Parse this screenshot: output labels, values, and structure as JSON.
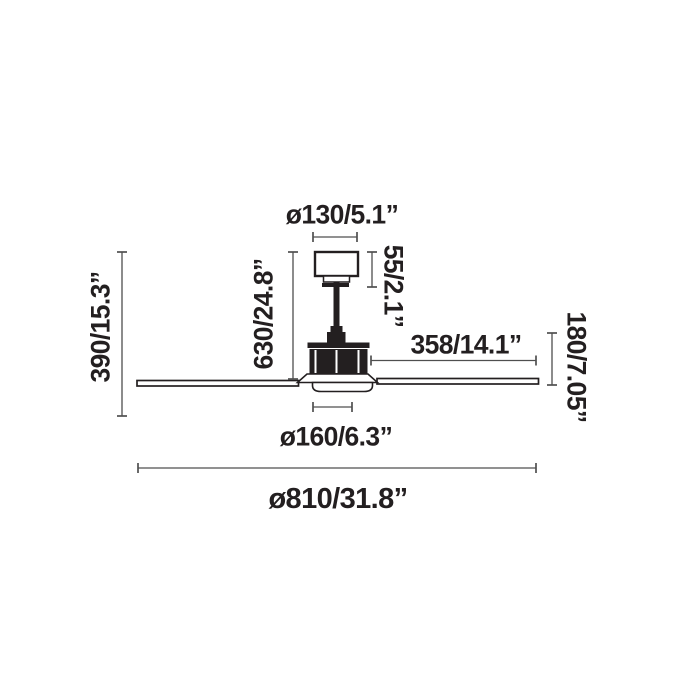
{
  "diagram": {
    "labels": {
      "canopy_diameter": "ø130/5.1”",
      "canopy_height": "55/2.1”",
      "height_to_blades": "630/24.8”",
      "total_height": "390/15.3”",
      "blade_length": "358/14.1”",
      "body_height": "180/7.05”",
      "body_diameter": "ø160/6.3”",
      "overall_diameter": "ø810/31.8”"
    },
    "colors": {
      "background": "#ffffff",
      "dimension_line": "#4f4f4f",
      "text": "#231f20",
      "drawing_outline": "#231f20",
      "drawing_fill": "#231f20"
    }
  }
}
